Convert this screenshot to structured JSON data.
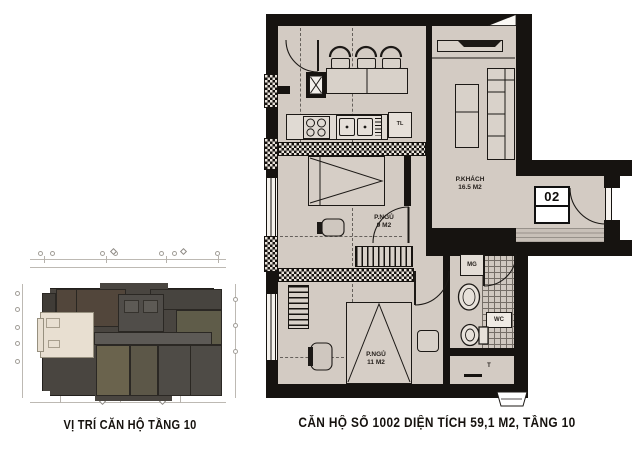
{
  "captions": {
    "overview": "VỊ TRÍ CĂN HỘ TẦNG 10",
    "apartment": "CĂN HỘ SỐ 1002 DIỆN TÍCH 59,1 M2, TẦNG 10"
  },
  "apartment_plan": {
    "unit_number": "02",
    "rooms": [
      {
        "name": "P.KHÁCH",
        "area": "16.5 M2"
      },
      {
        "name": "P.NGỦ",
        "area": "9 M2"
      },
      {
        "name": "P.NGỦ",
        "area": "11 M2"
      }
    ],
    "labels": {
      "fridge": "TL",
      "washer": "MG",
      "wc": "WC",
      "storage": "T"
    }
  },
  "colors": {
    "floor": "#d3cbc3",
    "wall": "#161310",
    "highlight_unit": "#e8dfd1",
    "overview_building": "#494540"
  }
}
